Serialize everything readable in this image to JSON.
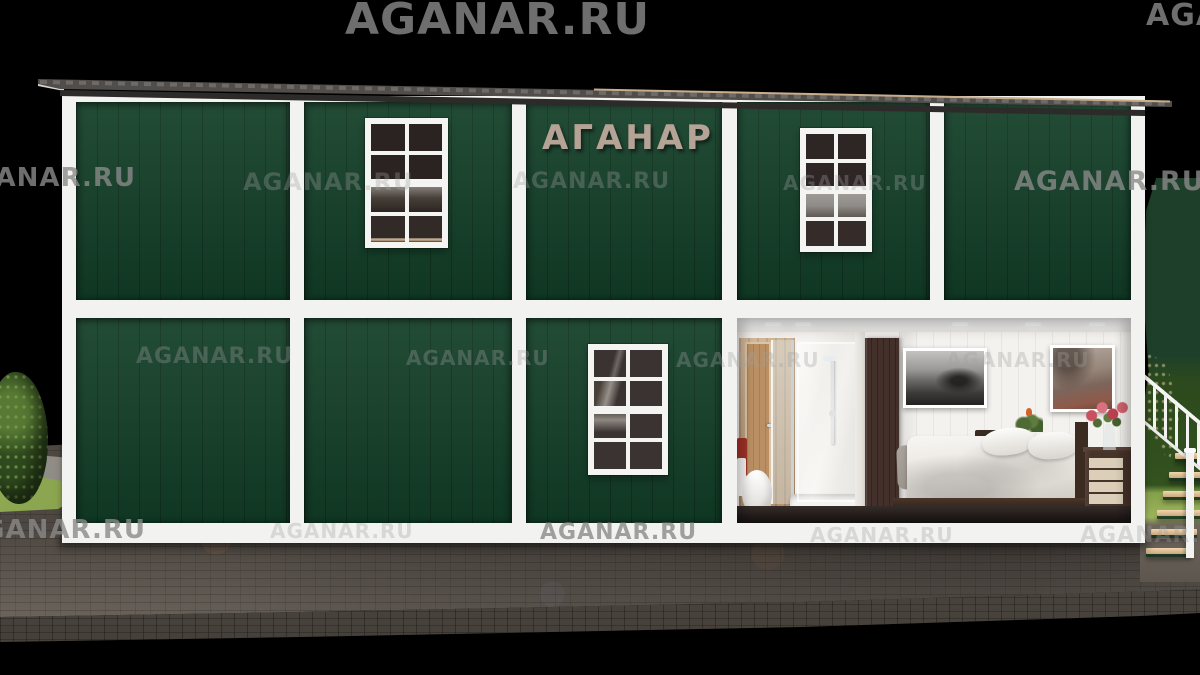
{
  "scene": {
    "description": "3D render of a dark-green two-storey modular container building with white framing, an interior cutaway showing a bathroom and a bedroom, a white exterior staircase on the right, bushes and cobblestone pavement",
    "background": "#000000"
  },
  "branding": {
    "sign_text": "АГАНАР",
    "watermark_text": "AGANAR.RU"
  },
  "palette": {
    "background": "#000000",
    "panel_green": "#123e27",
    "frame_white": "#f2f2f0",
    "roof_grey": "#504d4a",
    "roof_fascia": "#2d2b29",
    "sign_tan": "#b5a396",
    "pavement": "#6f665d",
    "pavement_edge": "#59524a",
    "bush": "#2f4a1e",
    "grass": "#9cb45c",
    "wood": "#c29d74",
    "wardrobe": "#44302a"
  },
  "building": {
    "storeys": 2,
    "upper_green_panels": 5,
    "lower_green_panels": 3,
    "upper_windows": 2,
    "lower_windows": 1,
    "window_panes_each": 8,
    "rooms": [
      {
        "name": "bathroom",
        "features": [
          "wooden door",
          "toilet",
          "red towel",
          "shower cabin with glass",
          "shower tray"
        ]
      },
      {
        "name": "bedroom",
        "features": [
          "dark wardrobe",
          "double bed with white bedding",
          "grey blanket",
          "two pillows",
          "black-and-white wall picture",
          "misty forest wall picture",
          "nightstand",
          "plant",
          "chest of drawers",
          "vase with pink flowers"
        ]
      }
    ],
    "staircase": "white exterior stair with railing on the right side"
  },
  "watermarks": [
    {
      "x": 345,
      "y": -6,
      "size": 44,
      "dim": false
    },
    {
      "x": 1146,
      "y": -2,
      "size": 30,
      "dim": false
    },
    {
      "x": -48,
      "y": 163,
      "size": 26,
      "dim": false
    },
    {
      "x": 243,
      "y": 168,
      "size": 24,
      "dim": true
    },
    {
      "x": 513,
      "y": 169,
      "size": 22,
      "dim": true
    },
    {
      "x": 783,
      "y": 171,
      "size": 20,
      "dim": true
    },
    {
      "x": 1014,
      "y": 166,
      "size": 27,
      "dim": false
    },
    {
      "x": 136,
      "y": 344,
      "size": 22,
      "dim": true
    },
    {
      "x": 406,
      "y": 346,
      "size": 20,
      "dim": true
    },
    {
      "x": 676,
      "y": 348,
      "size": 20,
      "dim": true
    },
    {
      "x": 946,
      "y": 348,
      "size": 20,
      "dim": true
    },
    {
      "x": -38,
      "y": 515,
      "size": 26,
      "dim": false
    },
    {
      "x": 270,
      "y": 519,
      "size": 20,
      "dim": true
    },
    {
      "x": 540,
      "y": 520,
      "size": 22,
      "dim": false
    },
    {
      "x": 810,
      "y": 523,
      "size": 20,
      "dim": true
    },
    {
      "x": 1080,
      "y": 523,
      "size": 22,
      "dim": true
    }
  ]
}
